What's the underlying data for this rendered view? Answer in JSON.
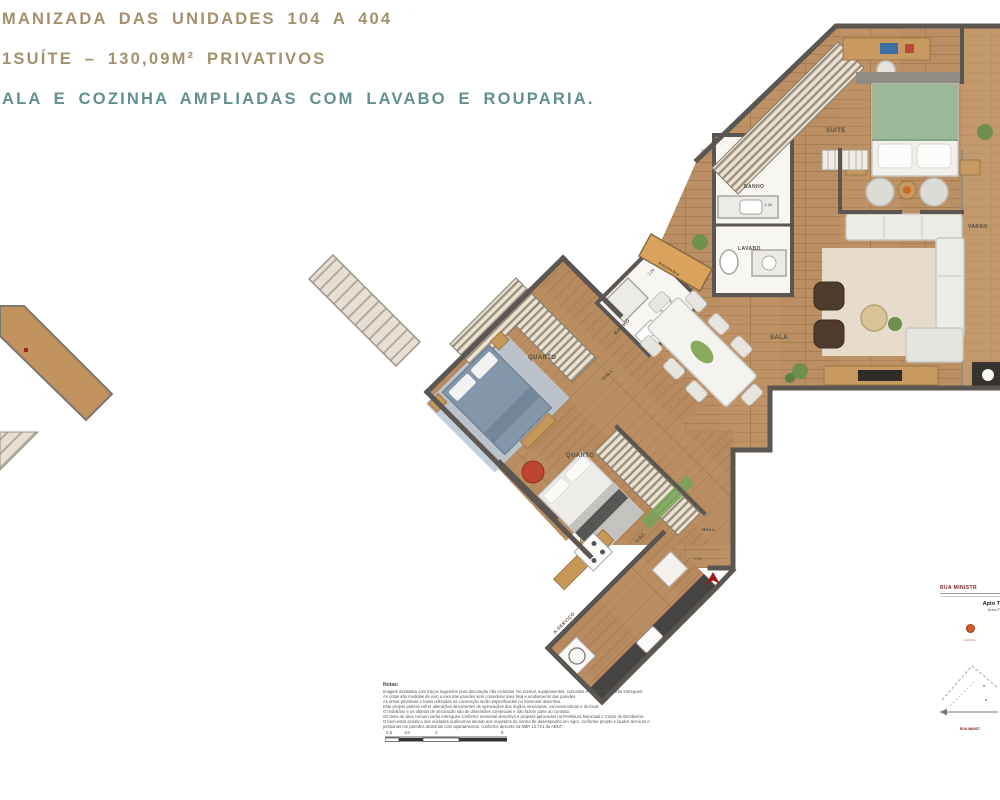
{
  "header": {
    "line1": "MANIZADA DAS UNIDADES 104 A 404",
    "line2": "1SUÍTE – 130,09M² PRIVATIVOS",
    "line3": "ALA E COZINHA AMPLIADAS COM LAVABO E ROUPARIA.",
    "accent_color": "#a5906b",
    "teal_color": "#628f8f"
  },
  "plan": {
    "rooms": [
      {
        "label": "SUITE"
      },
      {
        "label": "BANHO"
      },
      {
        "label": "LAVABO"
      },
      {
        "label": "ROUPARIA"
      },
      {
        "label": "BANHO"
      },
      {
        "label": "QUARTO"
      },
      {
        "label": "HALL"
      },
      {
        "label": "QUARTO"
      },
      {
        "label": "SALA"
      },
      {
        "label": "COZ."
      },
      {
        "label": "A.SERVIÇO"
      },
      {
        "label": "HALL"
      },
      {
        "label": "VARAN"
      }
    ],
    "dimensions": {
      "d1": "2,70",
      "d2": "1,36",
      "d3": "2,28",
      "d4": "1,80"
    },
    "entrance_arrow_color": "#9e1b1b",
    "wall_color": "#5b5651",
    "floor_color": "#bb8f63"
  },
  "notes": {
    "title": "Notas:",
    "lines": [
      "Imagem ilustrativa com traços sugeridos para decoração não incluídos. No normal, equipamentos, conceitos e objetos não serão entregues.",
      "As cotas são medidas de eixo a eixo das paredes sem considerar área final e acabamento das paredes.",
      "As áreas privativas e totais utilizadas na convenção serão especificadas no memorial descritivo.",
      "Este projeto poderá sofrer alterações decorrentes de aprovações dos órgãos municipais, concessionárias e do local.",
      "O mobiliário e os objetos de decoração são de dimensões comerciais e não fazem parte do contrato.",
      "Os itens de área comum serão entregues conforme memorial descritivo e projetos aprovados na Prefeitura Municipal e Corpo de Bombeiros.",
      "O bem-estar acústico das unidades autônomas atende aos requisitos da norma de desempenho em vigor, conforme projeto e laudos técnicos e",
      "persianas em paredes divisórias com apartamentos, conforme descrito na NBR 12.721 da ABNT."
    ]
  },
  "scalebar": {
    "l1": "0,5",
    "l2": "1m",
    "l3": "3",
    "l4": "5"
  },
  "keyplan": {
    "street_top": "RUA MINISTR",
    "apt_label": "Apto T",
    "area_label": "Área P",
    "marker_label": "LOCAL",
    "street_bottom": "RUA MINIST"
  }
}
